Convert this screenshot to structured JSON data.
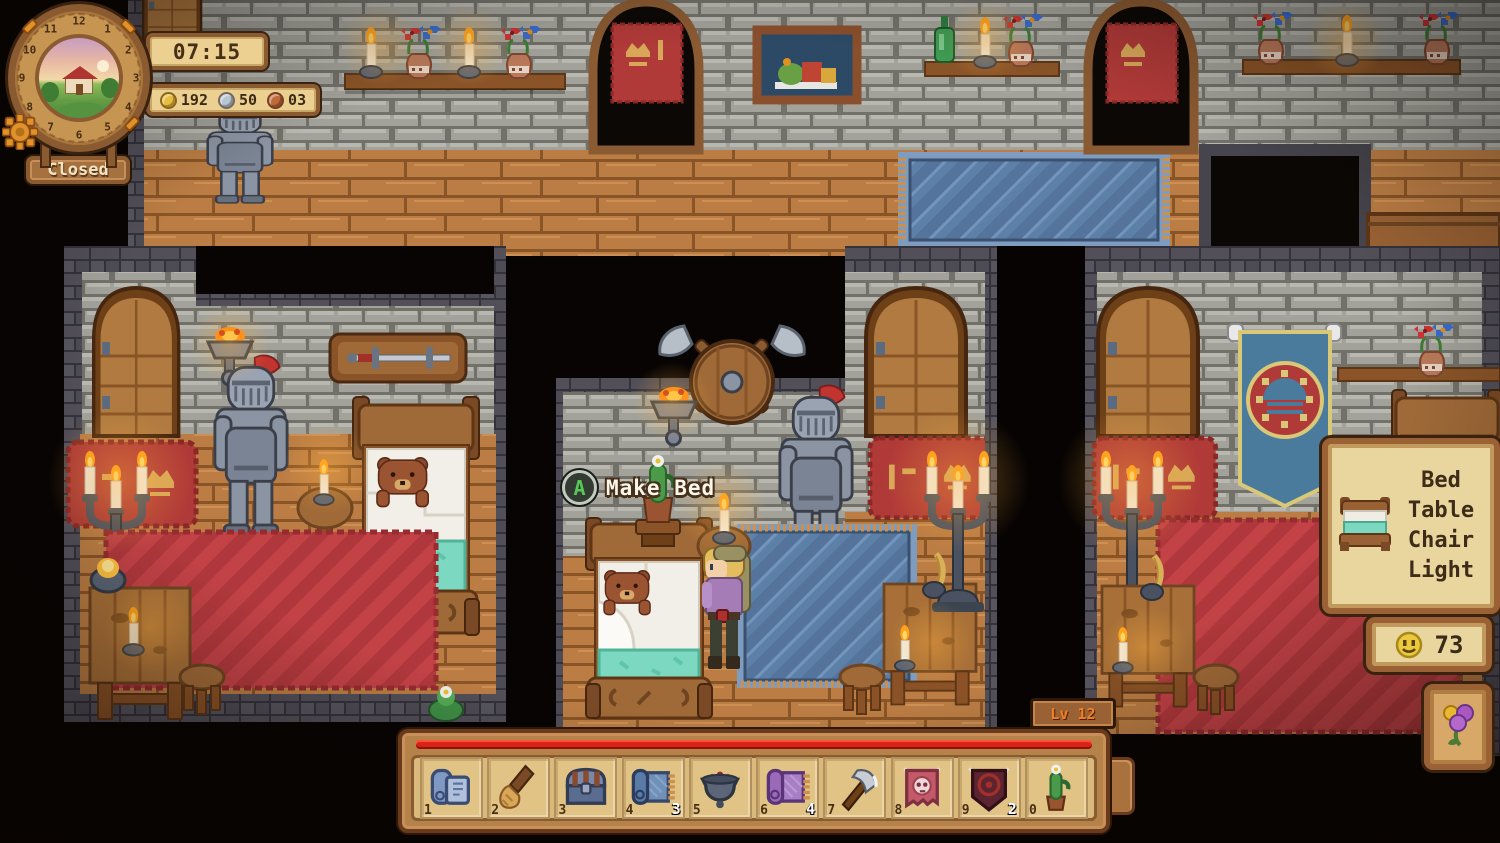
{
  "hud": {
    "time": "07:15",
    "status": "Closed",
    "clock_numbers": [
      "12",
      "1",
      "2",
      "3",
      "4",
      "5",
      "6",
      "7",
      "8",
      "9",
      "10",
      "11"
    ],
    "currencies": [
      {
        "id": "gold",
        "value": "192",
        "color": "#e9bd3f"
      },
      {
        "id": "silver",
        "value": "50",
        "color": "#b9c5d1"
      },
      {
        "id": "copper",
        "value": "03",
        "color": "#c06a3c"
      }
    ]
  },
  "prompt": {
    "button": "A",
    "label": "Make Bed"
  },
  "build_panel": {
    "items": [
      "Bed",
      "Table",
      "Chair",
      "Light"
    ]
  },
  "happiness_counter": {
    "value": "73"
  },
  "level_badge": "Lv 12",
  "hotbar": {
    "slots": [
      {
        "key": "1",
        "item": "blueprint",
        "count": ""
      },
      {
        "key": "2",
        "item": "broom",
        "count": ""
      },
      {
        "key": "3",
        "item": "chest",
        "count": ""
      },
      {
        "key": "4",
        "item": "rug-blue",
        "count": "3"
      },
      {
        "key": "5",
        "item": "cauldron",
        "count": ""
      },
      {
        "key": "6",
        "item": "rug-purple",
        "count": "4"
      },
      {
        "key": "7",
        "item": "axe",
        "count": ""
      },
      {
        "key": "8",
        "item": "banner-skull",
        "count": ""
      },
      {
        "key": "9",
        "item": "banner-dark",
        "count": "2"
      },
      {
        "key": "0",
        "item": "cactus",
        "count": ""
      }
    ]
  },
  "colors": {
    "progress_bar": "#d8231a",
    "panel_wood": "#9a6234",
    "panel_paper": "#e9d69e",
    "accent_flame": "#ffa018"
  }
}
